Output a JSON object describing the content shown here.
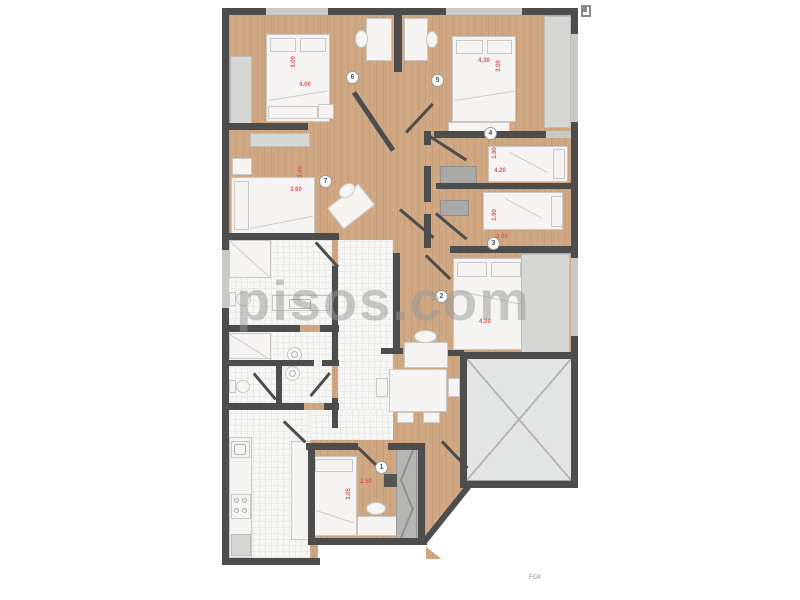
{
  "watermark": {
    "text": "pisos.com",
    "color": "#9e9e9e"
  },
  "footer": {
    "label": "FG4"
  },
  "plan": {
    "colors": {
      "wall": "#4d4d4d",
      "wood_floor": "#cfa783",
      "tile_floor": "#f6f6f5",
      "dimension_text": "#d65c5c",
      "terrace": "#e3e5e4"
    },
    "rooms": [
      {
        "number": "1",
        "dim_width": "2.50",
        "dim_depth": "3.05"
      },
      {
        "number": "2",
        "dim_width": "4.20"
      },
      {
        "number": "3",
        "dim_width": "3.00",
        "dim_depth": "1.90"
      },
      {
        "number": "4",
        "dim_width": "4.20",
        "dim_depth": "1.90"
      },
      {
        "number": "5",
        "dim_width": "4.30",
        "dim_depth": "3.00"
      },
      {
        "number": "6",
        "dim_width": "4.00",
        "dim_depth": "3.00"
      },
      {
        "number": "7",
        "dim_width": "3.60",
        "dim_depth": "3.45"
      }
    ]
  }
}
